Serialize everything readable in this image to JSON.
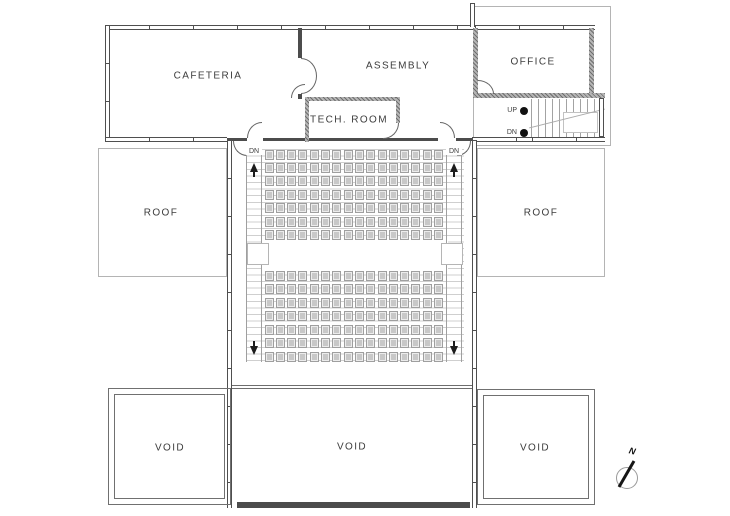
{
  "plan": {
    "rooms": {
      "cafeteria": {
        "label": "CAFETERIA"
      },
      "assembly": {
        "label": "ASSEMBLY"
      },
      "office": {
        "label": "OFFICE"
      },
      "tech_room": {
        "label": "TECH. ROOM"
      },
      "roof_left": {
        "label": "ROOF"
      },
      "roof_right": {
        "label": "ROOF"
      },
      "void_left": {
        "label": "VOID"
      },
      "void_center": {
        "label": "VOID"
      },
      "void_right": {
        "label": "VOID"
      }
    },
    "stairs": {
      "up_label": "UP",
      "down_label": "DN"
    },
    "auditorium": {
      "exit_left_label": "DN",
      "exit_right_label": "DN",
      "seating": {
        "rows_upper": 7,
        "rows_lower": 7,
        "seats_per_row": 16,
        "total_seats": 224
      }
    },
    "compass": {
      "north_label": "N"
    },
    "colors": {
      "wall": "#4c4c4c",
      "thin_line": "#b4b4b4",
      "seat_fill": "#ececec",
      "seat_inner": "#c8c8c8",
      "text": "#3c3c3c"
    }
  }
}
